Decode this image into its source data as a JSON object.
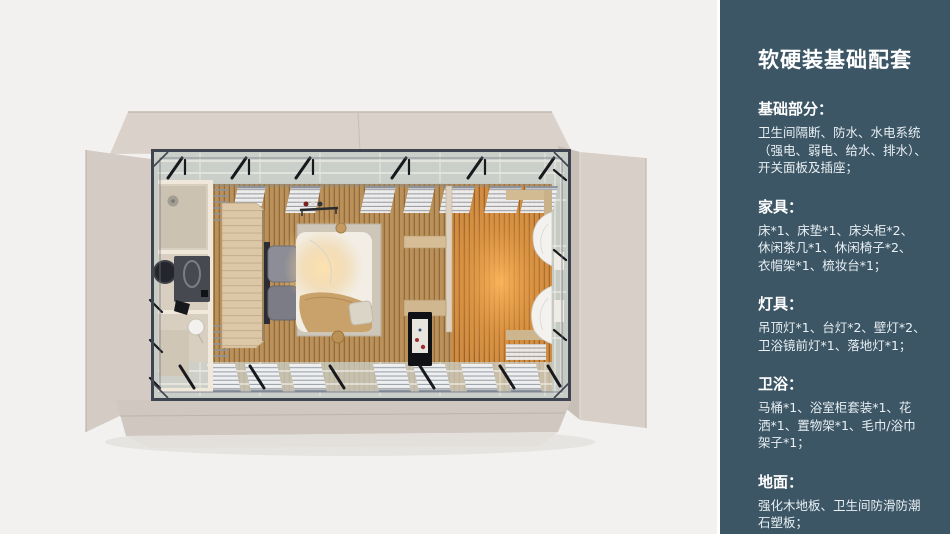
{
  "panel": {
    "bg_color": "#3c5665",
    "text_color": "#eef3f6",
    "title": "软硬装基础配套",
    "sections": [
      {
        "title": "基础部分：",
        "lines": [
          "卫生间隔断、防水、水电系统",
          "（强电、弱电、给水、排水）、",
          "开关面板及插座；"
        ]
      },
      {
        "title": "家具：",
        "lines": [
          "床*1、床垫*1、床头柜*2、",
          "休闲茶几*1、休闲椅子*2、",
          "衣帽架*1、梳妆台*1；"
        ]
      },
      {
        "title": "灯具：",
        "lines": [
          "吊顶灯*1、台灯*2、壁灯*2、",
          "卫浴镜前灯*1、落地灯*1；"
        ]
      },
      {
        "title": "卫浴：",
        "lines": [
          "马桶*1、浴室柜套装*1、花",
          "洒*1、置物架*1、毛巾/浴巾",
          "架子*1；"
        ]
      },
      {
        "title": "地面：",
        "lines": [
          "强化木地板、卫生间防滑防潮",
          "石塑板；"
        ]
      }
    ]
  },
  "floorplan": {
    "colors": {
      "background": "#f2f1ef",
      "wall_beige": "#d6cec7",
      "steel_frame": "#3e4450",
      "glass_band": "#c7ccc5",
      "wood_floor": "#bb9159",
      "warm_floor": "#cf8c42",
      "lamp_glow": "#f6d9a4",
      "bathroom_tile": "#d8cfc1"
    }
  }
}
